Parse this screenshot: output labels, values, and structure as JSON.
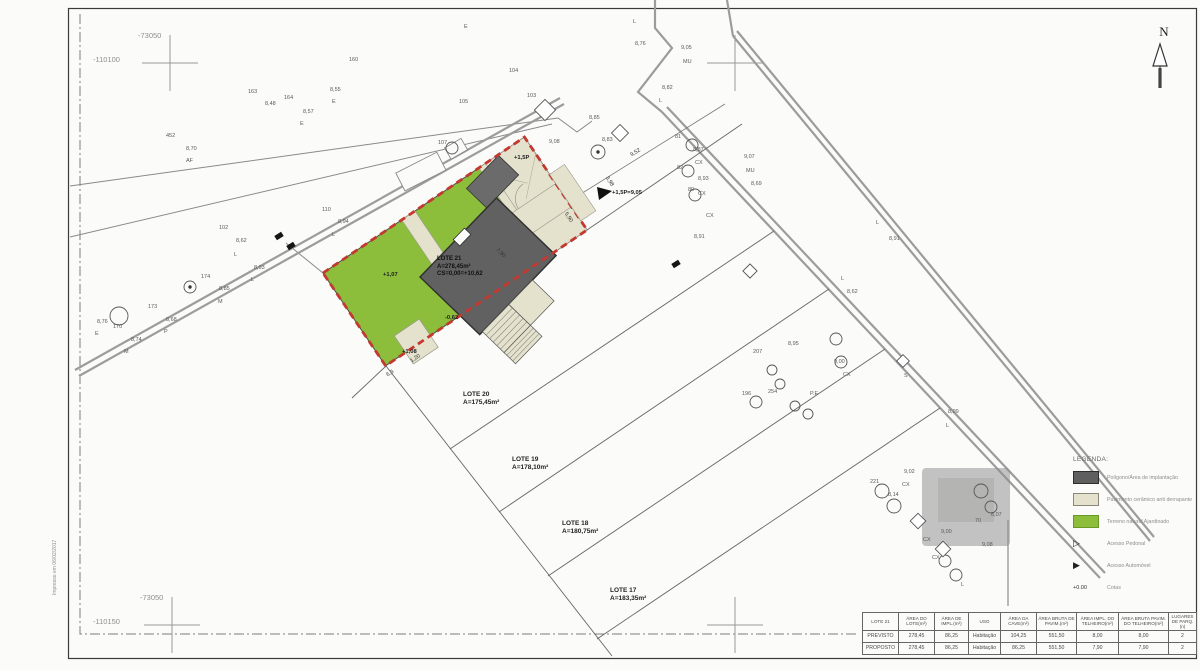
{
  "sheet": {
    "north_label": "N",
    "print_note": "Impresso em 06/02/2017"
  },
  "lots": {
    "main": {
      "name": "LOTE 21",
      "area": "A=278,45m²",
      "cs": "CS=0,00=+10,62"
    },
    "others": [
      {
        "name": "LOTE 20",
        "area": "A=175,45m²",
        "x": 463,
        "y": 391
      },
      {
        "name": "LOTE 19",
        "area": "A=178,10m²",
        "x": 512,
        "y": 456
      },
      {
        "name": "LOTE 18",
        "area": "A=180,75m²",
        "x": 562,
        "y": 520
      },
      {
        "name": "LOTE 17",
        "area": "A=183,35m²",
        "x": 610,
        "y": 587
      }
    ]
  },
  "legend": {
    "title": "LEGENDA:",
    "items": [
      {
        "type": "swatch",
        "color": "#5f5f5f",
        "border": "#2e2e2e",
        "label": "Polígono/Área de implantação"
      },
      {
        "type": "swatch",
        "color": "#e4e1cc",
        "border": "#8a8878",
        "label": "Pavimento cerâmico anti derrapante"
      },
      {
        "type": "swatch",
        "color": "#8cbe3c",
        "border": "#6a9a25",
        "label": "Terreno natural Ajardinado"
      },
      {
        "type": "triangle-open",
        "symbol": "▷",
        "label": "Acesso Pedonal"
      },
      {
        "type": "triangle-filled",
        "symbol": "▶",
        "label": "Acesso Automóvel"
      },
      {
        "type": "cota",
        "symbol": "+0.00",
        "label": "Cotas"
      }
    ]
  },
  "table": {
    "columns": [
      "LOTE 21",
      "ÁREA DO LOTE(m²)",
      "ÁREA DE IMPL.(m²)",
      "USO",
      "ÁREA DA CAVE(m²)",
      "ÁREA BRUTA DE PAVIM.(m²)",
      "ÁREA IMPL. DO TELHEIRO(m²)",
      "ÁREA BRUTA PAVIM. DO TELHEIRO(m²)",
      "LUGARES DE PARQ.(n)"
    ],
    "rows": [
      {
        "label": "PREVISTO",
        "values": [
          "278,45",
          "86,25",
          "Habitação",
          "104,25",
          "551,50",
          "8,00",
          "8,00",
          "2"
        ]
      },
      {
        "label": "PROPOSTO",
        "values": [
          "278,45",
          "86,25",
          "Habitação",
          "86,25",
          "551,50",
          "7,90",
          "7,90",
          "2"
        ]
      }
    ]
  },
  "annotations": [
    {
      "t": "-73050",
      "x": 138,
      "y": 32,
      "c": "coord"
    },
    {
      "t": "-110100",
      "x": 93,
      "y": 56,
      "c": "coord"
    },
    {
      "t": "-73050",
      "x": 140,
      "y": 594,
      "c": "coord"
    },
    {
      "t": "-110150",
      "x": 93,
      "y": 618,
      "c": "coord"
    },
    {
      "t": "160",
      "x": 349,
      "y": 58
    },
    {
      "t": "E",
      "x": 464,
      "y": 25
    },
    {
      "t": "8,55",
      "x": 330,
      "y": 88
    },
    {
      "t": "E",
      "x": 332,
      "y": 100
    },
    {
      "t": "164",
      "x": 284,
      "y": 96
    },
    {
      "t": "163",
      "x": 248,
      "y": 90
    },
    {
      "t": "8,48",
      "x": 265,
      "y": 102
    },
    {
      "t": "8,57",
      "x": 303,
      "y": 110
    },
    {
      "t": "E",
      "x": 300,
      "y": 122
    },
    {
      "t": "AF",
      "x": 186,
      "y": 159
    },
    {
      "t": "8,70",
      "x": 186,
      "y": 147
    },
    {
      "t": "452",
      "x": 166,
      "y": 134
    },
    {
      "t": "102",
      "x": 219,
      "y": 226
    },
    {
      "t": "8,62",
      "x": 236,
      "y": 239
    },
    {
      "t": "L",
      "x": 234,
      "y": 253
    },
    {
      "t": "8,93",
      "x": 254,
      "y": 266
    },
    {
      "t": "L",
      "x": 251,
      "y": 278
    },
    {
      "t": "174",
      "x": 201,
      "y": 275
    },
    {
      "t": "8,85",
      "x": 219,
      "y": 287
    },
    {
      "t": "M",
      "x": 218,
      "y": 300
    },
    {
      "t": "173",
      "x": 148,
      "y": 305
    },
    {
      "t": "8,68",
      "x": 166,
      "y": 318
    },
    {
      "t": "P",
      "x": 164,
      "y": 330
    },
    {
      "t": "170",
      "x": 113,
      "y": 325
    },
    {
      "t": "8,76",
      "x": 97,
      "y": 320
    },
    {
      "t": "E",
      "x": 95,
      "y": 332
    },
    {
      "t": "8,74",
      "x": 131,
      "y": 338
    },
    {
      "t": "M",
      "x": 124,
      "y": 350
    },
    {
      "t": "110",
      "x": 322,
      "y": 208
    },
    {
      "t": "8,94",
      "x": 338,
      "y": 220
    },
    {
      "t": "L",
      "x": 332,
      "y": 233
    },
    {
      "t": "105",
      "x": 459,
      "y": 100
    },
    {
      "t": "104",
      "x": 509,
      "y": 69
    },
    {
      "t": "103",
      "x": 527,
      "y": 94
    },
    {
      "t": "107",
      "x": 438,
      "y": 141
    },
    {
      "t": "9,08",
      "x": 549,
      "y": 140
    },
    {
      "t": "8,85",
      "x": 589,
      "y": 116
    },
    {
      "t": "8,83",
      "x": 602,
      "y": 138
    },
    {
      "t": "L",
      "x": 633,
      "y": 20
    },
    {
      "t": "8,76",
      "x": 635,
      "y": 42
    },
    {
      "t": "9,05",
      "x": 681,
      "y": 46
    },
    {
      "t": "MU",
      "x": 683,
      "y": 60
    },
    {
      "t": "8,82",
      "x": 662,
      "y": 86
    },
    {
      "t": "L",
      "x": 659,
      "y": 99
    },
    {
      "t": "81",
      "x": 675,
      "y": 135
    },
    {
      "t": "8,87",
      "x": 693,
      "y": 148
    },
    {
      "t": "CX",
      "x": 695,
      "y": 161
    },
    {
      "t": "82",
      "x": 677,
      "y": 166
    },
    {
      "t": "8,93",
      "x": 698,
      "y": 177
    },
    {
      "t": "80",
      "x": 688,
      "y": 188
    },
    {
      "t": "CX",
      "x": 698,
      "y": 192
    },
    {
      "t": "CX",
      "x": 706,
      "y": 214
    },
    {
      "t": "8,91",
      "x": 694,
      "y": 235
    },
    {
      "t": "9,07",
      "x": 744,
      "y": 155
    },
    {
      "t": "MU",
      "x": 746,
      "y": 169
    },
    {
      "t": "8,69",
      "x": 751,
      "y": 182
    },
    {
      "t": "L",
      "x": 876,
      "y": 221
    },
    {
      "t": "8,91",
      "x": 889,
      "y": 237
    },
    {
      "t": "L",
      "x": 841,
      "y": 277
    },
    {
      "t": "8,62",
      "x": 847,
      "y": 290
    },
    {
      "t": "9,00",
      "x": 834,
      "y": 360
    },
    {
      "t": "CX",
      "x": 843,
      "y": 373
    },
    {
      "t": "8,95",
      "x": 788,
      "y": 342
    },
    {
      "t": "207",
      "x": 753,
      "y": 350
    },
    {
      "t": "196",
      "x": 742,
      "y": 392
    },
    {
      "t": "254",
      "x": 768,
      "y": 390
    },
    {
      "t": "P.E",
      "x": 810,
      "y": 392
    },
    {
      "t": "S",
      "x": 904,
      "y": 374
    },
    {
      "t": "8,99",
      "x": 948,
      "y": 410
    },
    {
      "t": "L",
      "x": 946,
      "y": 424
    },
    {
      "t": "9,02",
      "x": 904,
      "y": 470
    },
    {
      "t": "CX",
      "x": 902,
      "y": 483
    },
    {
      "t": "221",
      "x": 870,
      "y": 480
    },
    {
      "t": "8,14",
      "x": 888,
      "y": 493
    },
    {
      "t": "70",
      "x": 975,
      "y": 519
    },
    {
      "t": "8,07",
      "x": 991,
      "y": 513
    },
    {
      "t": "9,08",
      "x": 982,
      "y": 543
    },
    {
      "t": "CX",
      "x": 923,
      "y": 538
    },
    {
      "t": "9,00",
      "x": 941,
      "y": 530
    },
    {
      "t": "CX",
      "x": 932,
      "y": 556
    },
    {
      "t": "L",
      "x": 961,
      "y": 583
    },
    {
      "t": "+1,07",
      "x": 383,
      "y": 273,
      "c": "elev"
    },
    {
      "t": "+1,5P",
      "x": 514,
      "y": 156,
      "c": "elev"
    },
    {
      "t": "-0,62",
      "x": 445,
      "y": 316,
      "c": "elev"
    },
    {
      "t": "+1,08",
      "x": 402,
      "y": 350,
      "c": "elev"
    },
    {
      "t": "+1,5P=9,05",
      "x": 612,
      "y": 191,
      "c": "elev"
    },
    {
      "t": "9,52",
      "x": 630,
      "y": 154,
      "r": -32,
      "c": "dim"
    },
    {
      "t": "3,98",
      "x": 608,
      "y": 176,
      "r": 56,
      "c": "dim"
    },
    {
      "t": "5,90",
      "x": 567,
      "y": 212,
      "r": 56,
      "c": "dim"
    },
    {
      "t": "7,90",
      "x": 498,
      "y": 248,
      "r": 44,
      "c": "dim"
    },
    {
      "t": "1,20",
      "x": 410,
      "y": 360,
      "r": -34,
      "c": "dim"
    },
    {
      "t": "6,3",
      "x": 386,
      "y": 374,
      "r": -34,
      "c": "dim"
    }
  ],
  "symbols": {
    "circles": [
      {
        "x": 452,
        "y": 148,
        "r": 6
      },
      {
        "x": 598,
        "y": 152,
        "r": 7,
        "dot": true
      },
      {
        "x": 692,
        "y": 145,
        "r": 6
      },
      {
        "x": 688,
        "y": 171,
        "r": 6
      },
      {
        "x": 695,
        "y": 195,
        "r": 6
      },
      {
        "x": 119,
        "y": 316,
        "r": 9
      },
      {
        "x": 190,
        "y": 287,
        "r": 6,
        "dot": true
      },
      {
        "x": 836,
        "y": 339,
        "r": 6
      },
      {
        "x": 841,
        "y": 362,
        "r": 6
      },
      {
        "x": 756,
        "y": 402,
        "r": 6
      },
      {
        "x": 772,
        "y": 370,
        "r": 5
      },
      {
        "x": 780,
        "y": 384,
        "r": 5
      },
      {
        "x": 795,
        "y": 406,
        "r": 5
      },
      {
        "x": 808,
        "y": 414,
        "r": 5
      },
      {
        "x": 882,
        "y": 491,
        "r": 7
      },
      {
        "x": 894,
        "y": 506,
        "r": 7
      },
      {
        "x": 945,
        "y": 561,
        "r": 6
      },
      {
        "x": 956,
        "y": 575,
        "r": 6
      },
      {
        "x": 981,
        "y": 491,
        "r": 7
      },
      {
        "x": 991,
        "y": 507,
        "r": 6
      }
    ],
    "diamonds": [
      {
        "x": 545,
        "y": 110,
        "s": 15
      },
      {
        "x": 620,
        "y": 133,
        "s": 12
      },
      {
        "x": 750,
        "y": 271,
        "s": 10
      },
      {
        "x": 903,
        "y": 361,
        "s": 9
      },
      {
        "x": 918,
        "y": 521,
        "s": 11
      },
      {
        "x": 943,
        "y": 549,
        "s": 11
      }
    ],
    "markers": [
      {
        "x": 279,
        "y": 236
      },
      {
        "x": 291,
        "y": 246
      },
      {
        "x": 676,
        "y": 264
      }
    ]
  }
}
